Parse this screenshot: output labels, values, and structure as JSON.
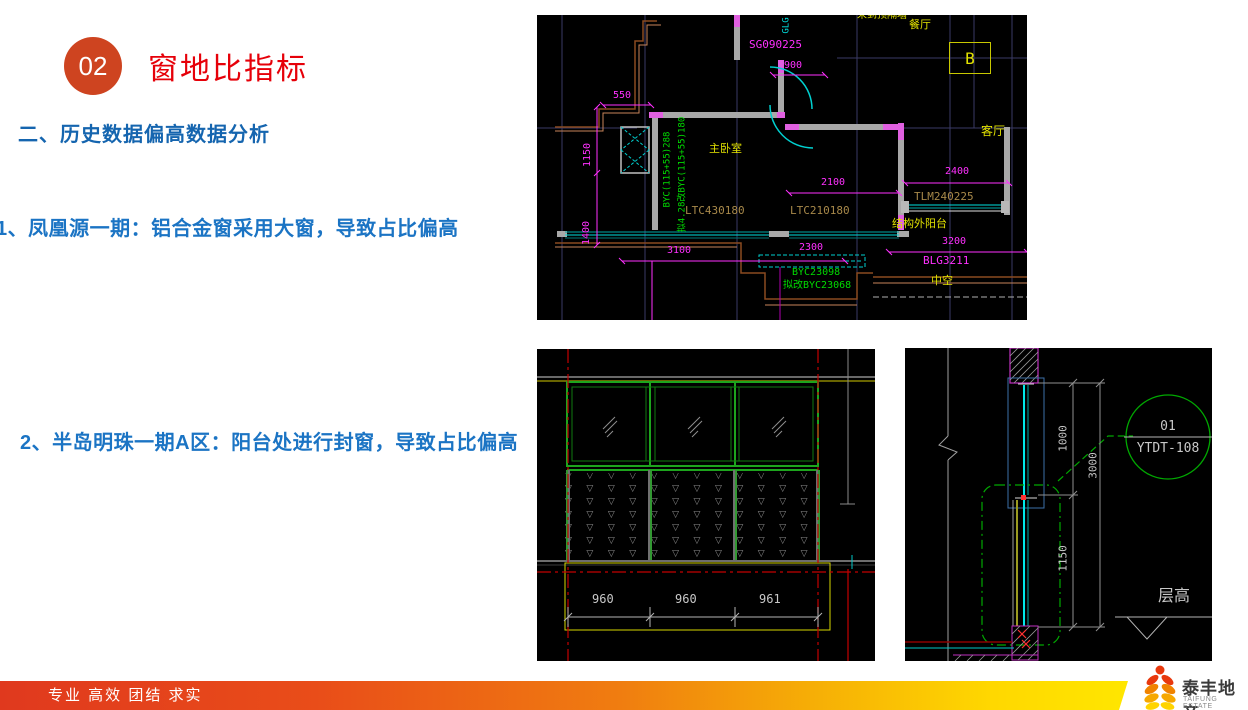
{
  "slide": {
    "badge": "02",
    "title": "窗地比指标",
    "heading": "二、历史数据偏高数据分析",
    "bullet1": "1、凤凰源一期：铝合金窗采用大窗，导致占比偏高",
    "bullet2": "2、半岛明珠一期A区：阳台处进行封窗，导致占比偏高"
  },
  "floorplan": {
    "top_partition": "未到顶隔墙",
    "glg": "GLG",
    "sg": "SG090225",
    "dim_900": "900",
    "grid_b": "B",
    "dining": "餐厅",
    "living": "客厅",
    "dim_550": "550",
    "dim_1150": "1150",
    "dim_1400": "1400",
    "master_bedroom": "主卧室",
    "byc_v1": "BYC(115+55)288",
    "byc_v2": "拟4.28改BYC(115+55)180",
    "ltc_left": "LTC430180",
    "ltc_right": "LTC210180",
    "dim_2100": "2100",
    "dim_2400": "2400",
    "tlm": "TLM240225",
    "balcony": "结构外阳台",
    "dim_3200": "3200",
    "blg": "BLG3211",
    "hollow": "中空",
    "dim_3100": "3100",
    "dim_2300": "2300",
    "byc_b1": "BYC23098",
    "byc_b2": "拟改BYC23068"
  },
  "elevation": {
    "dim_a": "960",
    "dim_b": "960",
    "dim_c": "961"
  },
  "section": {
    "dim_1000": "1000",
    "dim_3000": "3000",
    "dim_1150": "1150",
    "callout_no": "01",
    "callout_code": "YTDT-108",
    "level_label": "层高"
  },
  "footer": {
    "slogan": "专业 高效 团结 求实",
    "logo_cn": "泰丰地产",
    "logo_en": "TAIFUNG ESTATE"
  }
}
